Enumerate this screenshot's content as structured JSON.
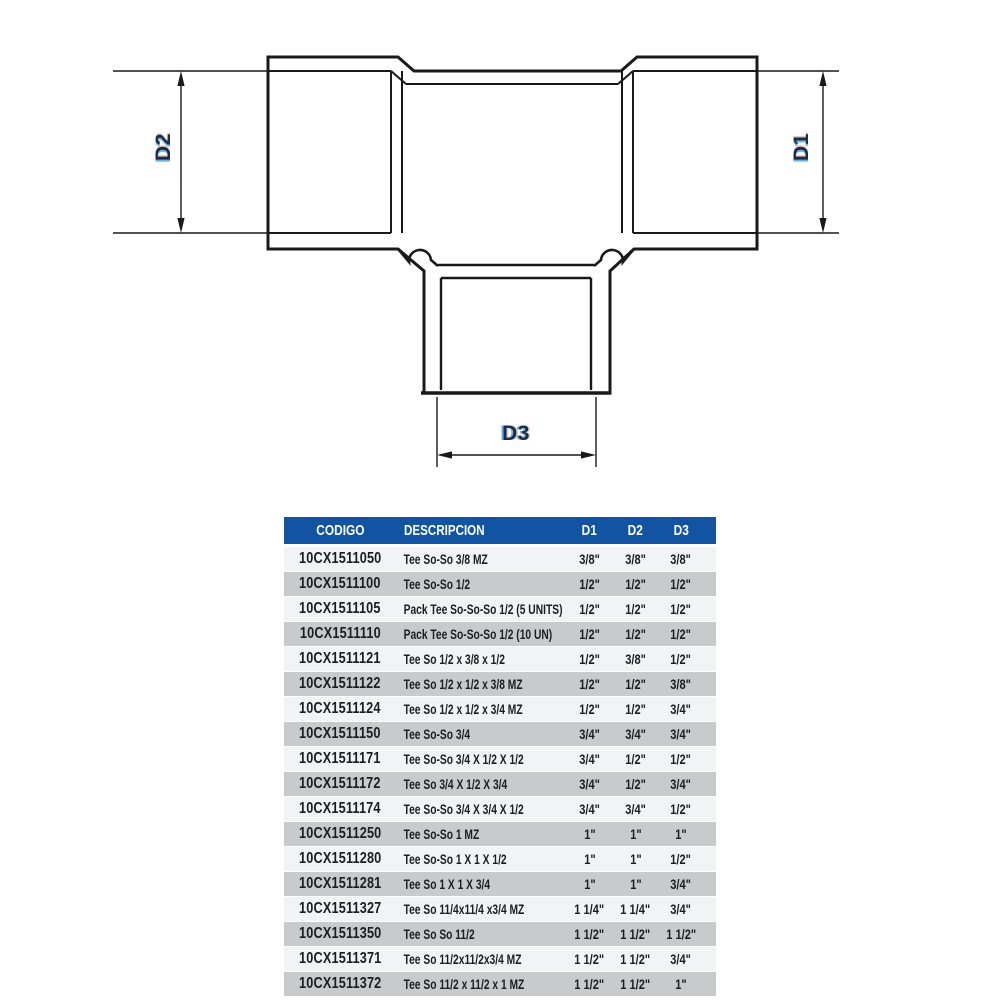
{
  "diagram": {
    "d1_label": "D1",
    "d2_label": "D2",
    "d3_label": "D3"
  },
  "table": {
    "headers": {
      "codigo": "CODIGO",
      "descripcion": "DESCRIPCION",
      "d1": "D1",
      "d2": "D2",
      "d3": "D3"
    },
    "rows": [
      {
        "code": "10CX1511050",
        "desc": "Tee So-So 3/8 MZ",
        "d1": "3/8\"",
        "d2": "3/8\"",
        "d3": "3/8\""
      },
      {
        "code": "10CX1511100",
        "desc": "Tee So-So 1/2",
        "d1": "1/2\"",
        "d2": "1/2\"",
        "d3": "1/2\""
      },
      {
        "code": "10CX1511105",
        "desc": "Pack Tee So-So-So 1/2 (5 UNITS)",
        "d1": "1/2\"",
        "d2": "1/2\"",
        "d3": "1/2\""
      },
      {
        "code": "10CX1511110",
        "desc": "Pack Tee So-So-So 1/2 (10 UN)",
        "d1": "1/2\"",
        "d2": "1/2\"",
        "d3": "1/2\""
      },
      {
        "code": "10CX1511121",
        "desc": "Tee So 1/2 x 3/8 x 1/2",
        "d1": "1/2\"",
        "d2": "3/8\"",
        "d3": "1/2\""
      },
      {
        "code": "10CX1511122",
        "desc": "Tee So 1/2 x 1/2 x 3/8 MZ",
        "d1": "1/2\"",
        "d2": "1/2\"",
        "d3": "3/8\""
      },
      {
        "code": "10CX1511124",
        "desc": "Tee So 1/2 x 1/2 x 3/4 MZ",
        "d1": "1/2\"",
        "d2": "1/2\"",
        "d3": "3/4\""
      },
      {
        "code": "10CX1511150",
        "desc": "Tee So-So 3/4",
        "d1": "3/4\"",
        "d2": "3/4\"",
        "d3": "3/4\""
      },
      {
        "code": "10CX1511171",
        "desc": "Tee So-So 3/4 X 1/2 X 1/2",
        "d1": "3/4\"",
        "d2": "1/2\"",
        "d3": "1/2\""
      },
      {
        "code": "10CX1511172",
        "desc": "Tee So 3/4 X 1/2 X 3/4",
        "d1": "3/4\"",
        "d2": "1/2\"",
        "d3": "3/4\""
      },
      {
        "code": "10CX1511174",
        "desc": "Tee So-So 3/4 X 3/4 X 1/2",
        "d1": "3/4\"",
        "d2": "3/4\"",
        "d3": "1/2\""
      },
      {
        "code": "10CX1511250",
        "desc": "Tee So-So 1 MZ",
        "d1": "1\"",
        "d2": "1\"",
        "d3": "1\""
      },
      {
        "code": "10CX1511280",
        "desc": "Tee So-So 1 X 1 X 1/2",
        "d1": "1\"",
        "d2": "1\"",
        "d3": "1/2\""
      },
      {
        "code": "10CX1511281",
        "desc": "Tee So 1 X 1 X 3/4",
        "d1": "1\"",
        "d2": "1\"",
        "d3": "3/4\""
      },
      {
        "code": "10CX1511327",
        "desc": "Tee So 11/4x11/4 x3/4 MZ",
        "d1": "1 1/4\"",
        "d2": "1 1/4\"",
        "d3": "3/4\""
      },
      {
        "code": "10CX1511350",
        "desc": "Tee So So 11/2",
        "d1": "1 1/2\"",
        "d2": "1 1/2\"",
        "d3": "1 1/2\""
      },
      {
        "code": "10CX1511371",
        "desc": "Tee So 11/2x11/2x3/4 MZ",
        "d1": "1 1/2\"",
        "d2": "1 1/2\"",
        "d3": "3/4\""
      },
      {
        "code": "10CX1511372",
        "desc": "Tee So 11/2 x 11/2 x 1 MZ",
        "d1": "1 1/2\"",
        "d2": "1 1/2\"",
        "d3": "1\""
      }
    ]
  },
  "colors": {
    "header_bg": "#1254a1",
    "row_light": "#f2f3f4",
    "row_gray": "#c9cacc",
    "line": "#191919",
    "label_navy": "#1c2b4a",
    "label_halo": "#58a8de"
  }
}
